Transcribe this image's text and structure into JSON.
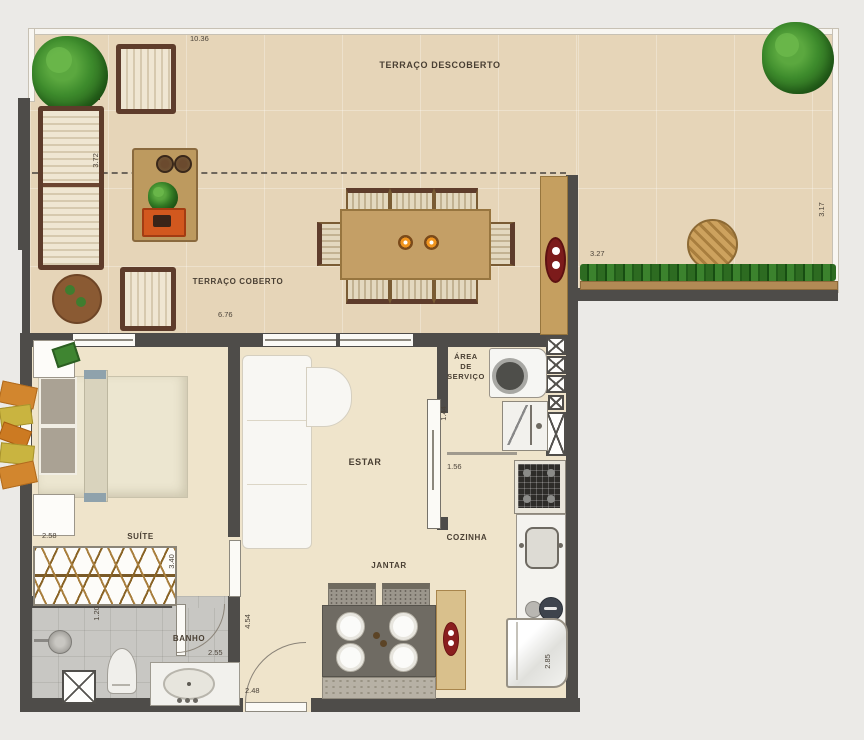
{
  "rooms": {
    "terraco_descoberto": "TERRAÇO DESCOBERTO",
    "terraco_coberto": "TERRAÇO COBERTO",
    "estar": "ESTAR",
    "suite": "SUÍTE",
    "banho": "BANHO",
    "jantar": "JANTAR",
    "cozinha": "COZINHA",
    "area_servico": "ÁREA\nDE\nSERVIÇO"
  },
  "dimensions": {
    "terrace_top_width": "10.36",
    "terrace_covered_depth": "3.72",
    "terrace_covered_width": "6.76",
    "terrace_right_width": "3.27",
    "terrace_right_depth": "3.17",
    "suite_width": "2.58",
    "suite_length": "3.40",
    "banho_width": "1.20",
    "banho_length": "2.55",
    "living_length": "4.54",
    "entry_width": "2.48",
    "servico_depth": "1.44",
    "kitchen_passage": "1.56",
    "kitchen_length": "2.85"
  },
  "colors": {
    "wall": "#4e4c49",
    "terrace_floor": "#e6d5b8",
    "interior_floor": "#efe4cb",
    "bath_floor": "#c8c7c3",
    "wood": "#c49f66",
    "dark_wood_frame": "#5e3c2b",
    "rug": "#b3a68b",
    "accent_red": "#7e1d1d",
    "accent_orange": "#e2661c",
    "plant_green": "#3d8b2c"
  }
}
